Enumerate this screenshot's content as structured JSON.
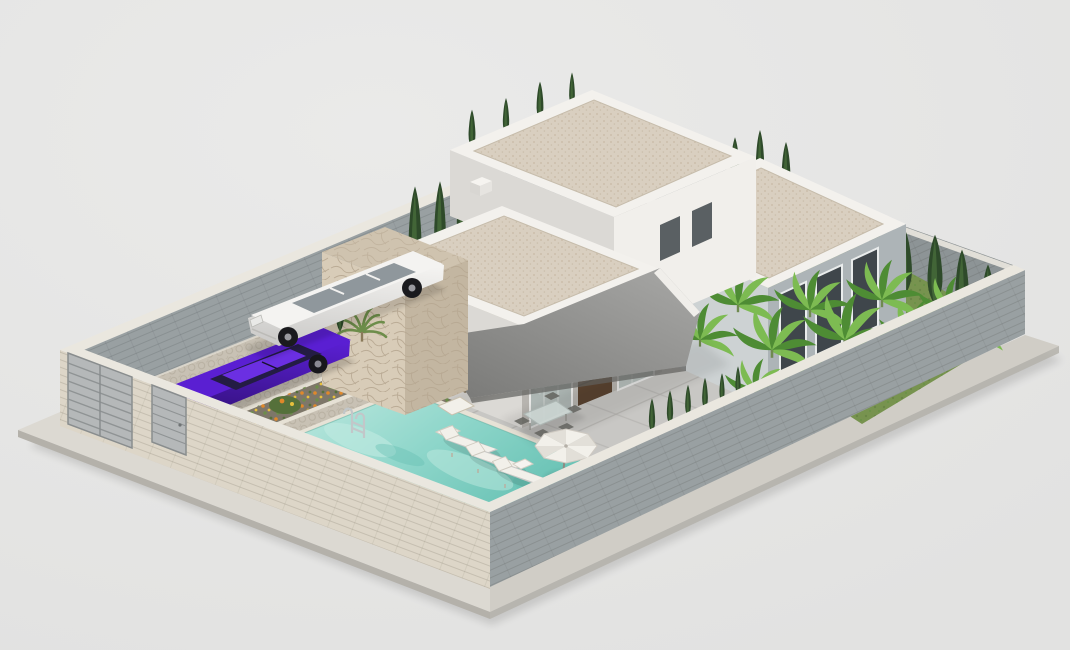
{
  "scene": {
    "type": "architectural-3d-render",
    "subject": "modern single-storey villa plot with pool, driveway, two cars and walled garden",
    "view": "axonometric from south-east, light gray studio background",
    "objects": [
      "sidewalk-plinth",
      "perimeter-wall-back-left",
      "perimeter-wall-back-right",
      "perimeter-wall-front-left",
      "perimeter-wall-front-right",
      "driveway-gate",
      "pedestrian-door",
      "cobblestone-driveway",
      "purple-sedan",
      "white-suv",
      "flower-bed",
      "flower-bed",
      "swimming-pool",
      "pool-ladder",
      "tiled-patio",
      "lawn",
      "banana-plants",
      "cypress-trees",
      "main-villa-block",
      "rear-villa-block",
      "side-villa-block",
      "stone-feature-wall",
      "terrace-canopy",
      "glass-facade",
      "gravel-flat-roofs",
      "roof-chimney",
      "outdoor-sofa-set",
      "outdoor-dining-set",
      "sun-loungers",
      "parasol",
      "side-table"
    ],
    "colors": {
      "background": "#e2e2e1",
      "background_top": "#eaeae9",
      "sidewalk": "#dcd9d2",
      "sidewalk_dark": "#d0cdc6",
      "plinth_edge": "#b4b1aa",
      "wall_cap": "#eae7df",
      "wall_gray": "#99a0a2",
      "wall_gray_dark": "#8d9496",
      "wall_light": "#ddd6c8",
      "ground_tile": "#d3d2cf",
      "tile_line": "#b9b8b4",
      "cobble": "#c8c1b4",
      "cobble_dot": "#a89f8f",
      "curb": "#e6e1d5",
      "soil": "#7e7769",
      "flower_orange": "#e0882a",
      "flower_yellow": "#e7c03c",
      "foliage": "#6d8d4a",
      "foliage_dark": "#55703a",
      "grass": "#77934f",
      "grass_dot": "#5e7a3e",
      "banana_dark": "#4e8c34",
      "banana_light": "#7dbb52",
      "cypress": "#2e4a2a",
      "cypress_light": "#476b3b",
      "roof_gravel": "#d9cfc0",
      "gravel_dot": "#c0b29b",
      "parapet": "#f3f1ed",
      "wall_white_bright": "#f1efeb",
      "wall_white_shade": "#dbd9d5",
      "wall_blue": "#adb4b7",
      "window_dark": "#3f464b",
      "window_frame": "#e9ecec",
      "glass_top": "#8d9896",
      "glass_bottom": "#b9c1be",
      "wood_slat": "#5a4330",
      "canopy_light": "#a8a8a6",
      "canopy_dark": "#787876",
      "canopy_fascia": "#f0eeea",
      "stone_light": "#d8ccb8",
      "stone_shade": "#c3b6a1",
      "stone_top": "#cfc3af",
      "stone_line": "#b0a089",
      "pool_coping": "#e7e2d6",
      "water_light": "#bfe9e0",
      "water_mid": "#8ed6ca",
      "water_deep": "#63bfb1",
      "chrome": "#c2c7c9",
      "cushion": "#f2f0ea",
      "wicker": "#7b6e59",
      "car_purple": "#5a1fd2",
      "car_purple_dark": "#2e0f70",
      "car_purple_roof": "#6b2fe2",
      "car_glass": "#241c44",
      "car_white": "#f4f3f1",
      "car_white_shade": "#c9c8c6",
      "suv_glass": "#8f979c",
      "taillight_red": "#c2262f",
      "gate": "#b5b8b9",
      "gate_line": "#8f9394",
      "shadow": "#000000"
    }
  }
}
